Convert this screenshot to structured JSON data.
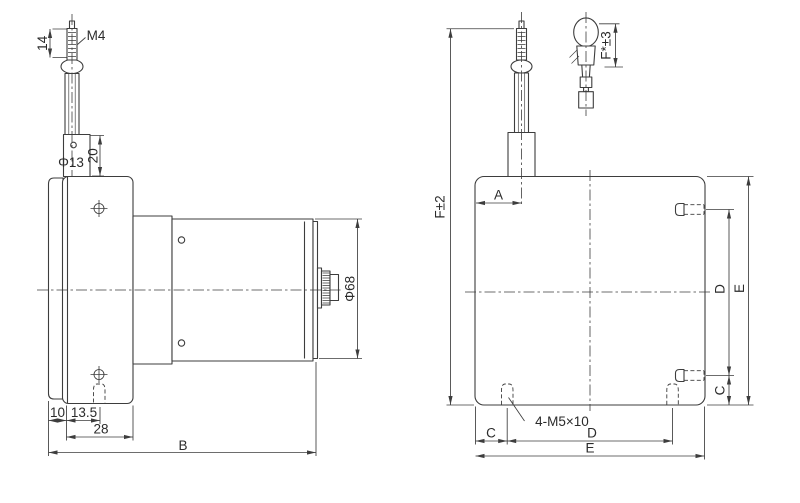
{
  "drawing": {
    "left_view": {
      "labels": {
        "stud_length": "14",
        "thread": "M4",
        "outlet_dia": "Φ13",
        "outlet_height": "20",
        "body_dia": "Φ68",
        "plate_overhang": "10",
        "hole_offset": "13.5",
        "plate_width": "28",
        "total_length": "B"
      }
    },
    "right_view": {
      "labels": {
        "total_height": "F±2",
        "wire_offset": "A",
        "side_hole_spacing": "D",
        "side_height": "E",
        "side_hole_edge": "C",
        "screw_spec": "4-M5×10",
        "bottom_hole_edge": "C",
        "bottom_hole_spacing": "D",
        "bottom_width": "E"
      }
    },
    "detail_view": {
      "labels": {
        "fitting_length": "F*±3"
      }
    },
    "colors": {
      "line": "#3d3d3d",
      "text": "#2b2b2b",
      "background": "#ffffff"
    }
  }
}
